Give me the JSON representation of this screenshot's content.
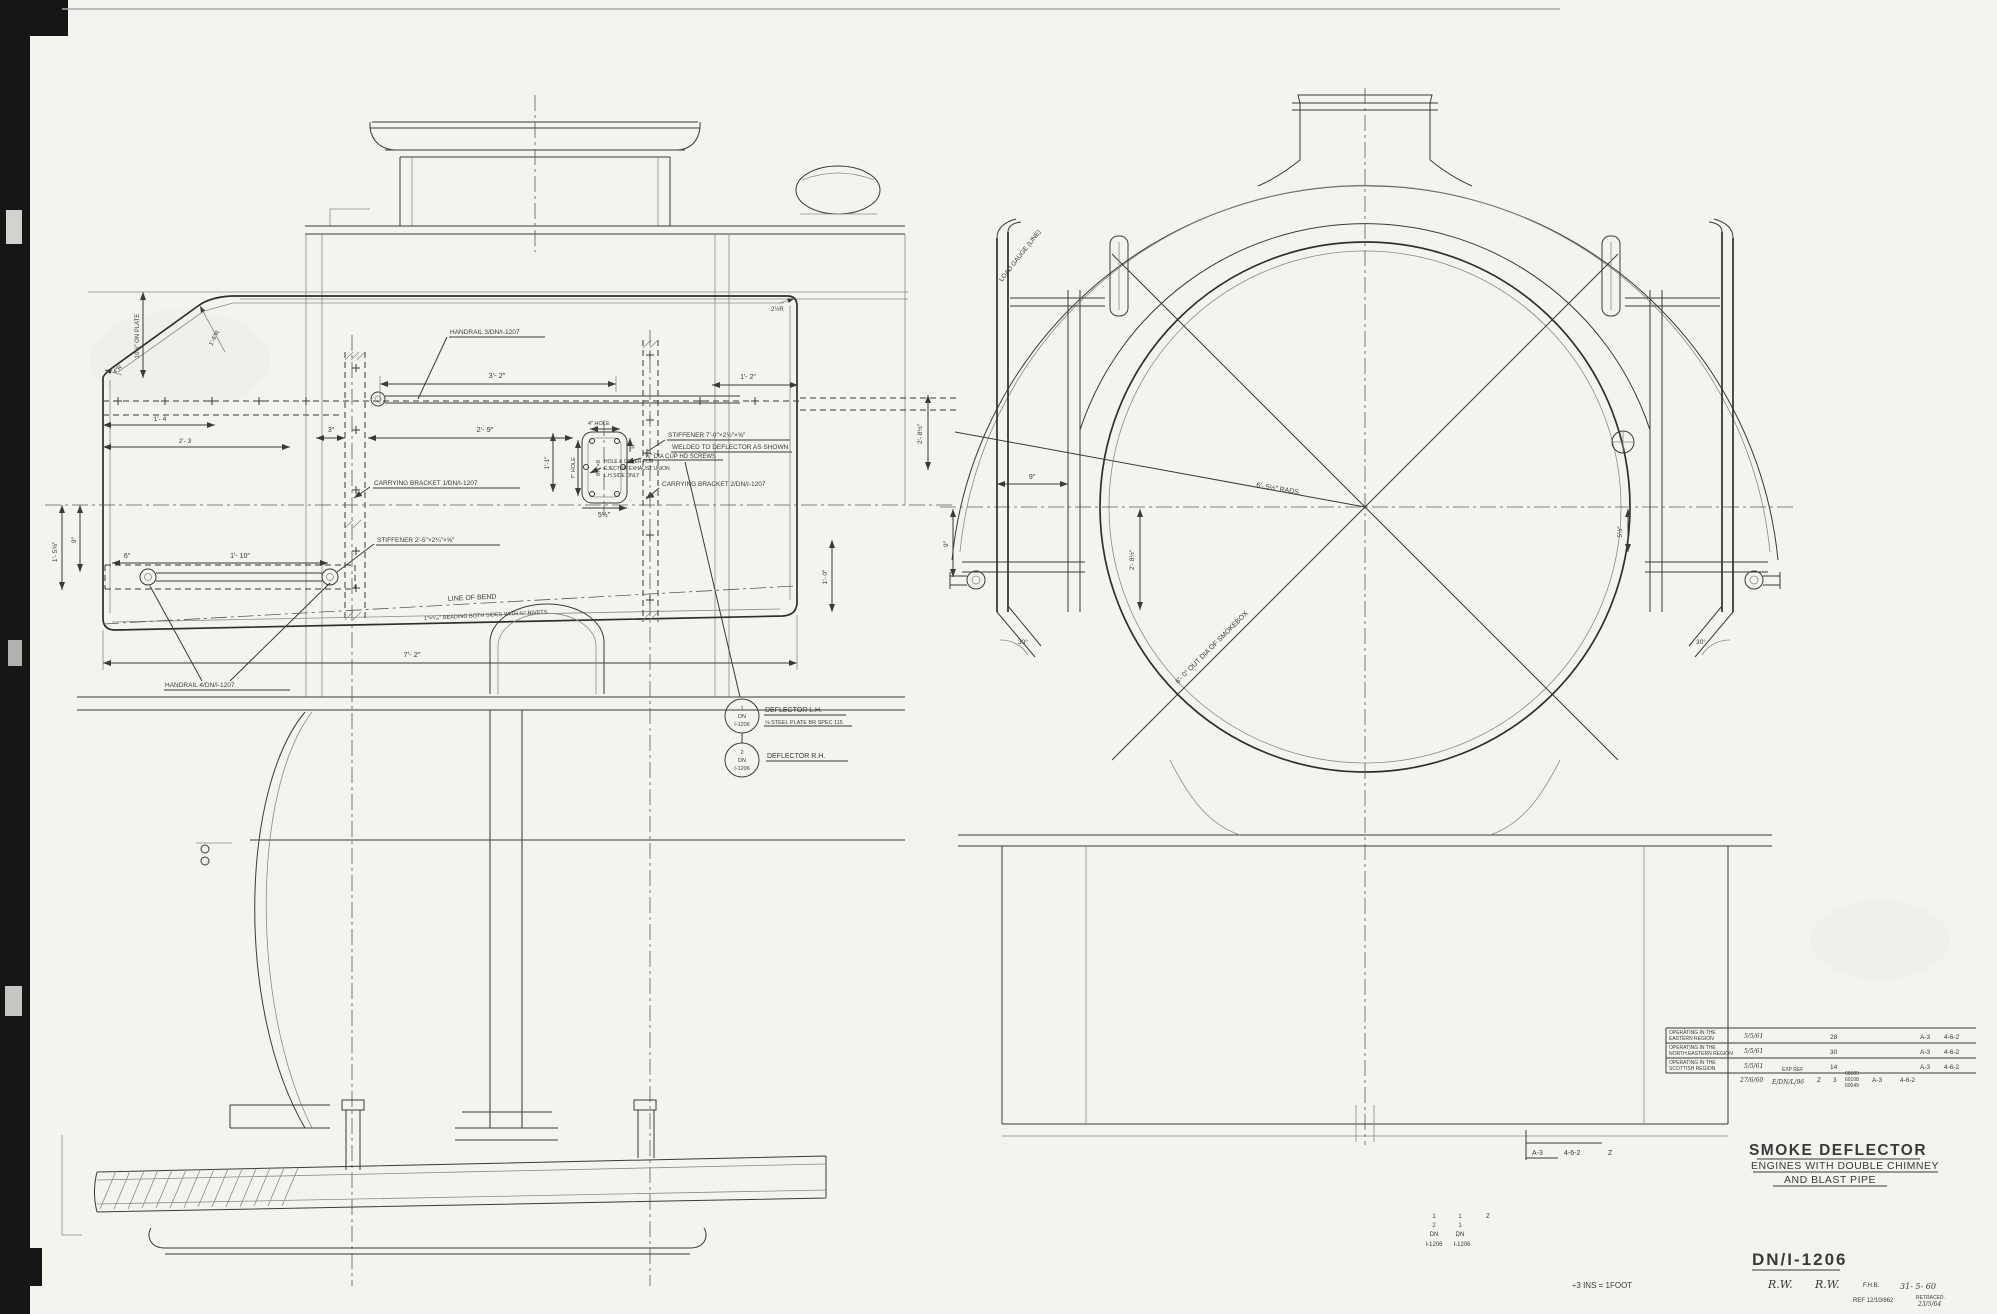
{
  "colors": {
    "paper": "#f4f3ee",
    "ink": "#3a3a3c",
    "film_edge": "#141414"
  },
  "side_view": {
    "labels": {
      "handrail3": "HANDRAIL 3/DN/I-1207",
      "handrail4": "HANDRAIL 4/DN/I-1207",
      "bracket1": "CARRYING BRACKET 1/DN/I-1207",
      "bracket2": "CARRYING BRACKET 2/DN/I-1207",
      "stiffener1": "STIFFENER 7′-0″×2½″×⅝″",
      "stiffener1b": "WELDED TO DEFLECTOR AS SHOWN",
      "screws": "⅝″ DIA CUP HD SCREWS",
      "hole_cover1": "HOLE & COVER FOR",
      "hole_cover2": "EJECTOR EXHAUST UNION",
      "hole_cover3": "L.H SIDE ONLY",
      "stiffener2": "STIFFENER 2′-5″×2¼″×⅝″",
      "line_of_bend": "LINE OF BEND",
      "beading": "1″×⁵⁄₁₆″ BEADING BOTH SIDES WITH ⅜″ RIVETS"
    },
    "dims": {
      "d32": "3′- 2″",
      "d12": "1′- 2″",
      "d29": "2′- 9″",
      "d3": "3″",
      "d11": "1′-1″",
      "d4hole": "4″ HOLE",
      "d7hole": "7″ HOLE",
      "d8x8": "8¼″×8",
      "d34": "¾″",
      "d5h": "5½″",
      "d6": "6″",
      "d110": "1′- 10″",
      "d72": "7′- 2″",
      "d10plate": "10½″ ON PLATE",
      "d4r": "4″R",
      "d16r": "1′-6″R",
      "d2hr": "2½R",
      "d14": "1′- 4",
      "d23": "2′- 3",
      "d9left": "9″",
      "d158": "1′- 5⅝″",
      "d10": "1′- 0″",
      "d28mid": "2′- 8½″"
    }
  },
  "balloons": {
    "b1": {
      "num": "1",
      "mid": "DN",
      "bot": "I-1206",
      "label": "DEFLECTOR L.H.",
      "sub": "⅛ STEEL PLATE BR SPEC 115"
    },
    "b2": {
      "num": "2",
      "mid": "DN",
      "bot": "I-1206",
      "label": "DEFLECTOR R.H."
    }
  },
  "front_view": {
    "load_gauge": "LOAD GAUGE (LINE)",
    "rads": "6′- 5½″ RADS.",
    "smokebox_dia": "6′- 0″ OUT DIA OF SMOKEBOX",
    "d9": "9″",
    "d9b": "9″",
    "d5h": "5½″",
    "d28": "2′- 8½″",
    "d30L": "30°",
    "d30R": "30°"
  },
  "revision_table": {
    "rows": [
      {
        "l1": "OPERATING IN THE",
        "l2": "EASTERN REGION",
        "date": "5/5/61",
        "qty": "28",
        "cls": "A-3",
        "whl": "4-6-2"
      },
      {
        "l1": "OPERATING IN THE",
        "l2": "NORTH EASTERN REGION",
        "date": "5/5/61",
        "qty": "30",
        "cls": "A-3",
        "whl": "4-6-2"
      },
      {
        "l1": "OPERATING IN THE",
        "l2": "SCOTTISH REGION",
        "date": "5/5/61",
        "qty": "14",
        "cls": "A-3",
        "whl": "4-6-2"
      }
    ],
    "footer": {
      "date": "27/6/60",
      "exp": "EXP REF",
      "ref": "E/DN/L/96",
      "z": "Z",
      "three": "3",
      "eng1": "60109",
      "eng2": "60108",
      "eng3": "60049",
      "cls": "A-3",
      "whl": "4-6-2"
    }
  },
  "class_box": {
    "c1": "A-3",
    "c2": "4-6-2",
    "c3": "Z"
  },
  "part_stack": {
    "r1a": "1",
    "r1b": "1",
    "r1c": "Z",
    "r2a": "2",
    "r2b": "1",
    "r3a": "DN",
    "r3b": "DN",
    "r4a": "I-1206",
    "r4b": "I-1206"
  },
  "title_block": {
    "title": "SMOKE DEFLECTOR",
    "subtitle1": "ENGINES WITH DOUBLE CHIMNEY",
    "subtitle2": "AND BLAST PIPE",
    "drawing_number": "DN/I-1206",
    "sig1": "R.W.",
    "sig2": "R.W.",
    "checker": "F.H.B.",
    "date": "31- 5- 60",
    "ref": "REF 12/10/862",
    "retraced1": "RETRACED.",
    "retraced2": "23/5/64",
    "scale_note": "÷3 INS = 1FOOT"
  }
}
